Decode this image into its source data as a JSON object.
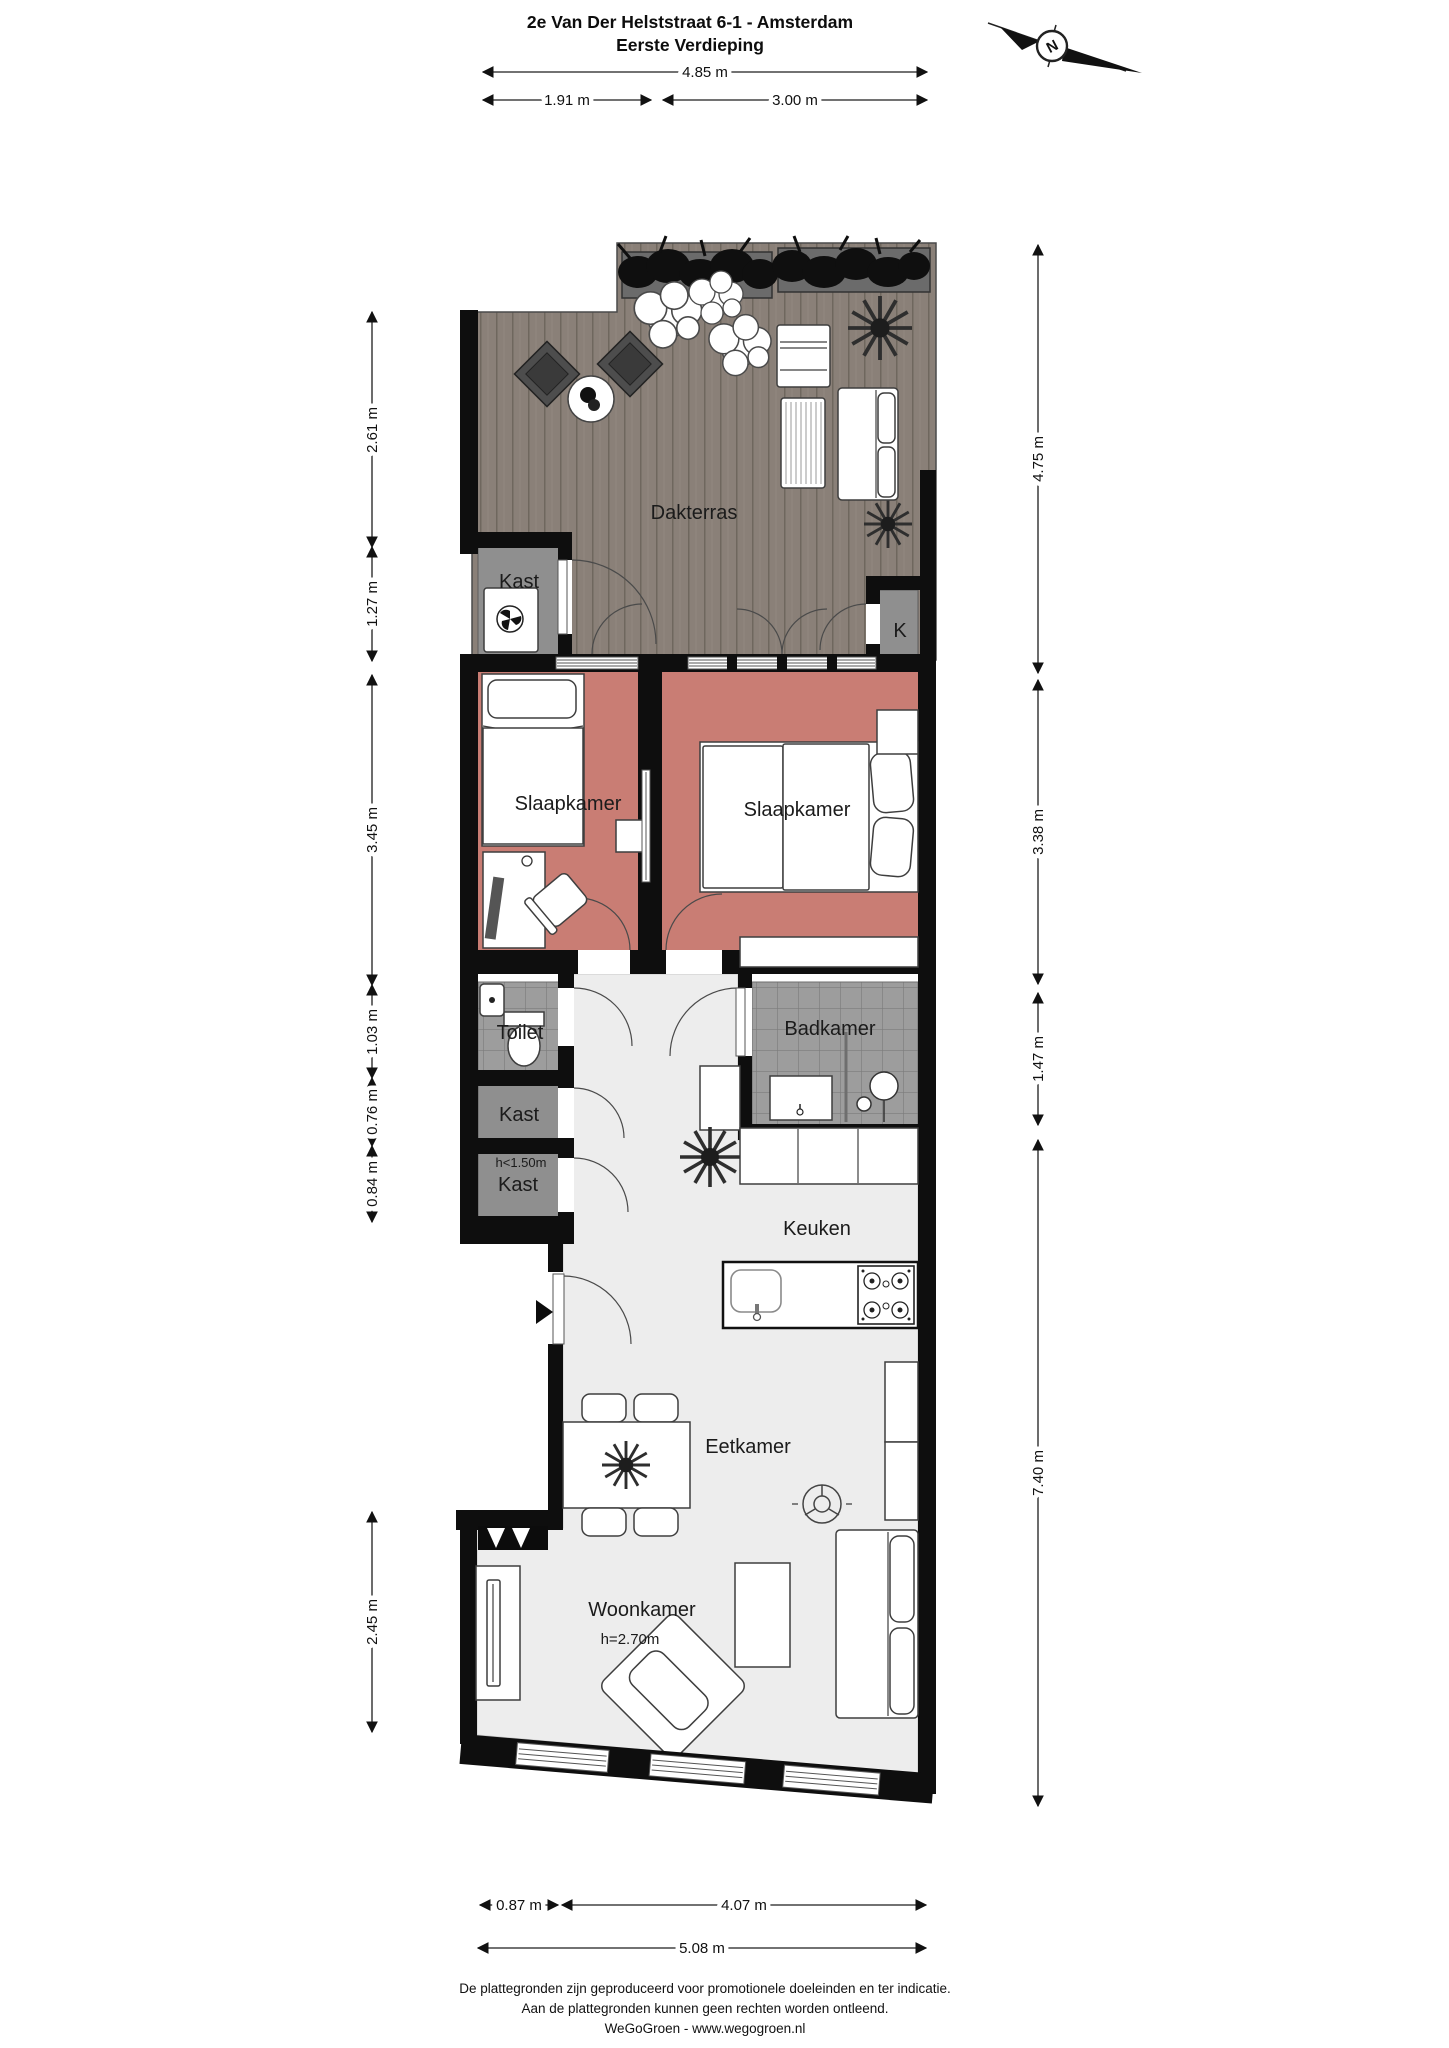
{
  "title": {
    "line1": "2e Van Der Helststraat 6-1 - Amsterdam",
    "line2": "Eerste Verdieping"
  },
  "compass": {
    "letter": "N"
  },
  "rooms": {
    "dakterras": "Dakterras",
    "kast_top": "Kast",
    "k_closet": "K",
    "slaapkamer_left": "Slaapkamer",
    "slaapkamer_right": "Slaapkamer",
    "toilet": "Toilet",
    "badkamer": "Badkamer",
    "kast_mid": "Kast",
    "kast_low_note": "h<1.50m",
    "kast_low": "Kast",
    "keuken": "Keuken",
    "eetkamer": "Eetkamer",
    "woonkamer": "Woonkamer",
    "woonkamer_height": "h=2.70m"
  },
  "dimensions": {
    "top": [
      {
        "v": "4.85 m"
      },
      {
        "v": "1.91 m"
      },
      {
        "v": "3.00 m"
      }
    ],
    "left": [
      {
        "v": "2.61 m"
      },
      {
        "v": "1.27 m"
      },
      {
        "v": "3.45 m"
      },
      {
        "v": "1.03 m"
      },
      {
        "v": "0.76 m"
      },
      {
        "v": "0.84 m"
      },
      {
        "v": "2.45 m"
      }
    ],
    "right": [
      {
        "v": "4.75 m"
      },
      {
        "v": "3.38 m"
      },
      {
        "v": "1.47 m"
      },
      {
        "v": "7.40 m"
      }
    ],
    "bottom": [
      {
        "v": "0.87 m"
      },
      {
        "v": "4.07 m"
      },
      {
        "v": "5.08 m"
      }
    ]
  },
  "footer": {
    "line1": "De plattegronden zijn geproduceerd voor promotionele doeleinden en ter indicatie.",
    "line2": "Aan de plattegronden kunnen geen rechten worden ontleend.",
    "line3": "WeGoGroen -  www.wegogroen.nl"
  },
  "colors": {
    "wall": "#0e0e0e",
    "bedroom_floor": "#c97d74",
    "tile_floor": "#9d9d9d",
    "closet_floor": "#8f8f8f",
    "deck": "#8a8078",
    "main_floor": "#ededed",
    "line": "#3e3e3e"
  }
}
